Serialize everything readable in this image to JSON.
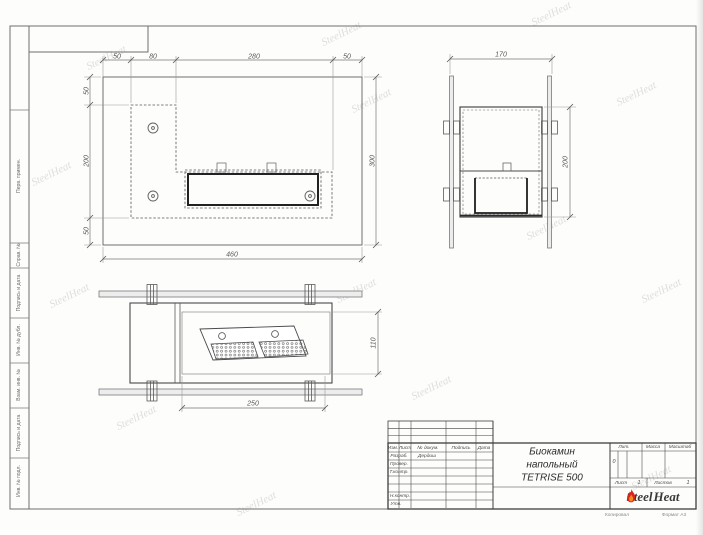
{
  "margin_labels": {
    "perv": "Перв. примен.",
    "sprav": "Справ. №",
    "podpis1": "Подпись и дата",
    "inv_dubl": "Инв. № дубл.",
    "vzam": "Взам. инв. №",
    "podpis2": "Подпись и дата",
    "inv_podl": "Инв. № подл."
  },
  "dims": {
    "front_top": [
      "50",
      "80",
      "280",
      "50"
    ],
    "front_left": [
      "50",
      "200",
      "50"
    ],
    "front_right": "300",
    "front_bottom": "460",
    "side_top": "170",
    "side_right": "200",
    "plan_bottom": "250",
    "plan_right": "110"
  },
  "stamp": {
    "col_izm": "Изм.",
    "col_list": "Лист",
    "col_dokum": "№ докум.",
    "col_podpis": "Подпись",
    "col_data": "Дата",
    "row_razrab": "Разраб.",
    "razrab_name": "Дердиш",
    "row_prover": "Провер.",
    "row_tkontr": "Т.контр.",
    "row_nkontr": "Н.контр.",
    "row_utv": "Утв.",
    "title_line1": "Биокамин",
    "title_line2": "напольный",
    "title_line3": "TETRISE 500",
    "lit_label": "Лит.",
    "massa_label": "Масса",
    "masshtab_label": "Масштаб",
    "lit_value": "0",
    "list_label": "Лист",
    "list_value": "1",
    "listov_label": "Листов",
    "listov_value": "1",
    "logo_left": "Steel",
    "logo_right": "Heat"
  },
  "footer": {
    "copied": "Копировал",
    "format": "Формат А3"
  },
  "watermark": {
    "text": "SteelHeat"
  }
}
